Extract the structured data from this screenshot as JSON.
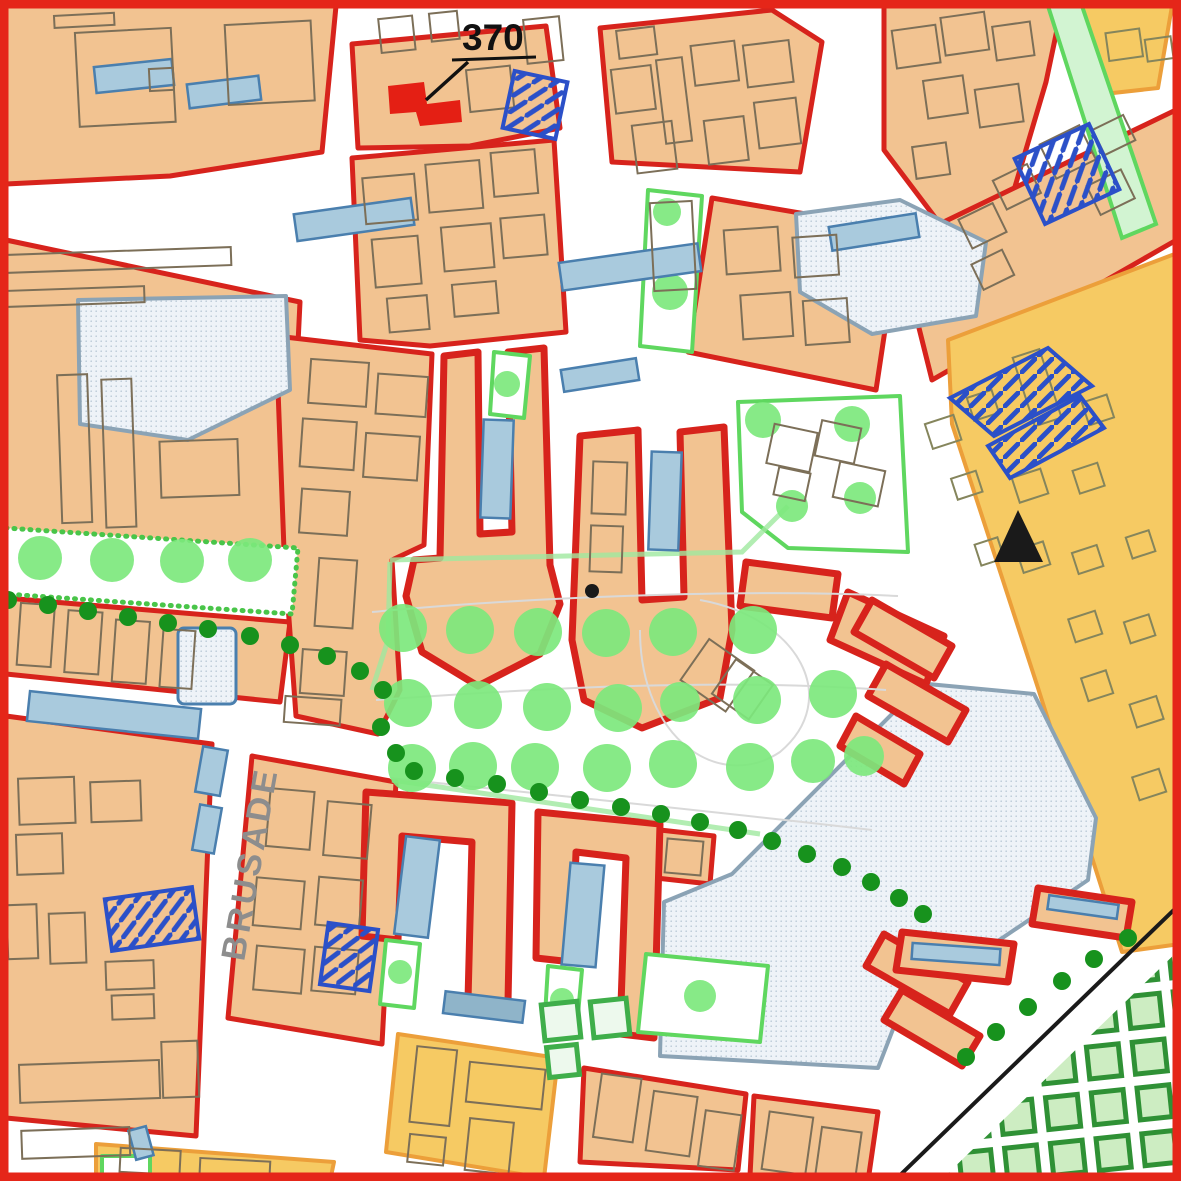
{
  "map": {
    "labels": {
      "parcel_number": "370",
      "street_name": "BRUSADE"
    },
    "markers": {
      "triangle": "black-triangle-point-marker",
      "highlight": "red-filled-building-parcel-370",
      "reference_dot": "black-reference-dot"
    },
    "colors": {
      "frame_red": "#e52619",
      "zone_red": "#d7231c",
      "block_tan": "#f2c391",
      "block_gold": "#f6ca63",
      "gold_stroke": "#ec9f3a",
      "building_gray": "#7c6f58",
      "building_olive": "#85855c",
      "tree_green": "#7de87d",
      "tree_dark": "#17921d",
      "green_edge": "#5fd75f",
      "square_fill": "#cdedc2",
      "square_stroke": "#2f9135",
      "blue_fill": "#a9cadd",
      "blue_stroke": "#4a7fae",
      "stipple_fill": "#eef3f8",
      "stipple_stroke": "#8ba3b5",
      "hatch_blue": "#2b50c8",
      "label_black": "#111111",
      "street_label_gray": "#8d8d8d",
      "marker_red": "#e41f14",
      "line_black": "#1a1a1a"
    }
  }
}
